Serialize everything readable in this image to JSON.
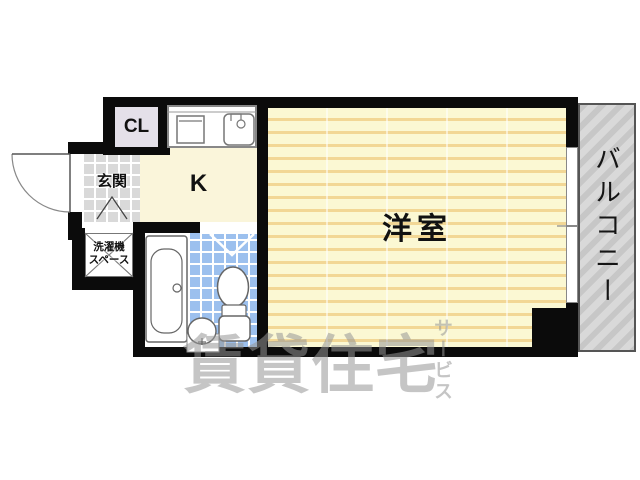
{
  "rooms": {
    "living": {
      "label": "洋室"
    },
    "kitchen": {
      "label": "K"
    },
    "closet": {
      "label": "CL"
    },
    "entrance": {
      "label": "玄関"
    },
    "laundry": {
      "line1": "洗濯機",
      "line2": "スペース"
    },
    "balcony": {
      "label": "バルコニー"
    }
  },
  "watermark": {
    "main": "賃貸住宅",
    "suffix": "サービス"
  },
  "icons": [
    "front-door-arc-icon",
    "entrance-step-icon",
    "laundry-cross-icon",
    "bathtub-icon",
    "toilet-icon",
    "wash-basin-icon",
    "stove-icon",
    "kitchen-sink-icon",
    "bathroom-door-swing-icon",
    "sliding-window-icon"
  ],
  "colors": {
    "wall": "#0b0b0b",
    "living_floor": "#fbf8d3",
    "living_stripe": "#f2d795",
    "kitchen_floor": "#faf5da",
    "closet_floor": "#e4e0e9",
    "entrance_tile": "#d9d9d9",
    "bath_tile": "#9cc0ee",
    "balcony": "#c7c7c7",
    "watermark": "rgba(150,150,150,0.55)"
  }
}
